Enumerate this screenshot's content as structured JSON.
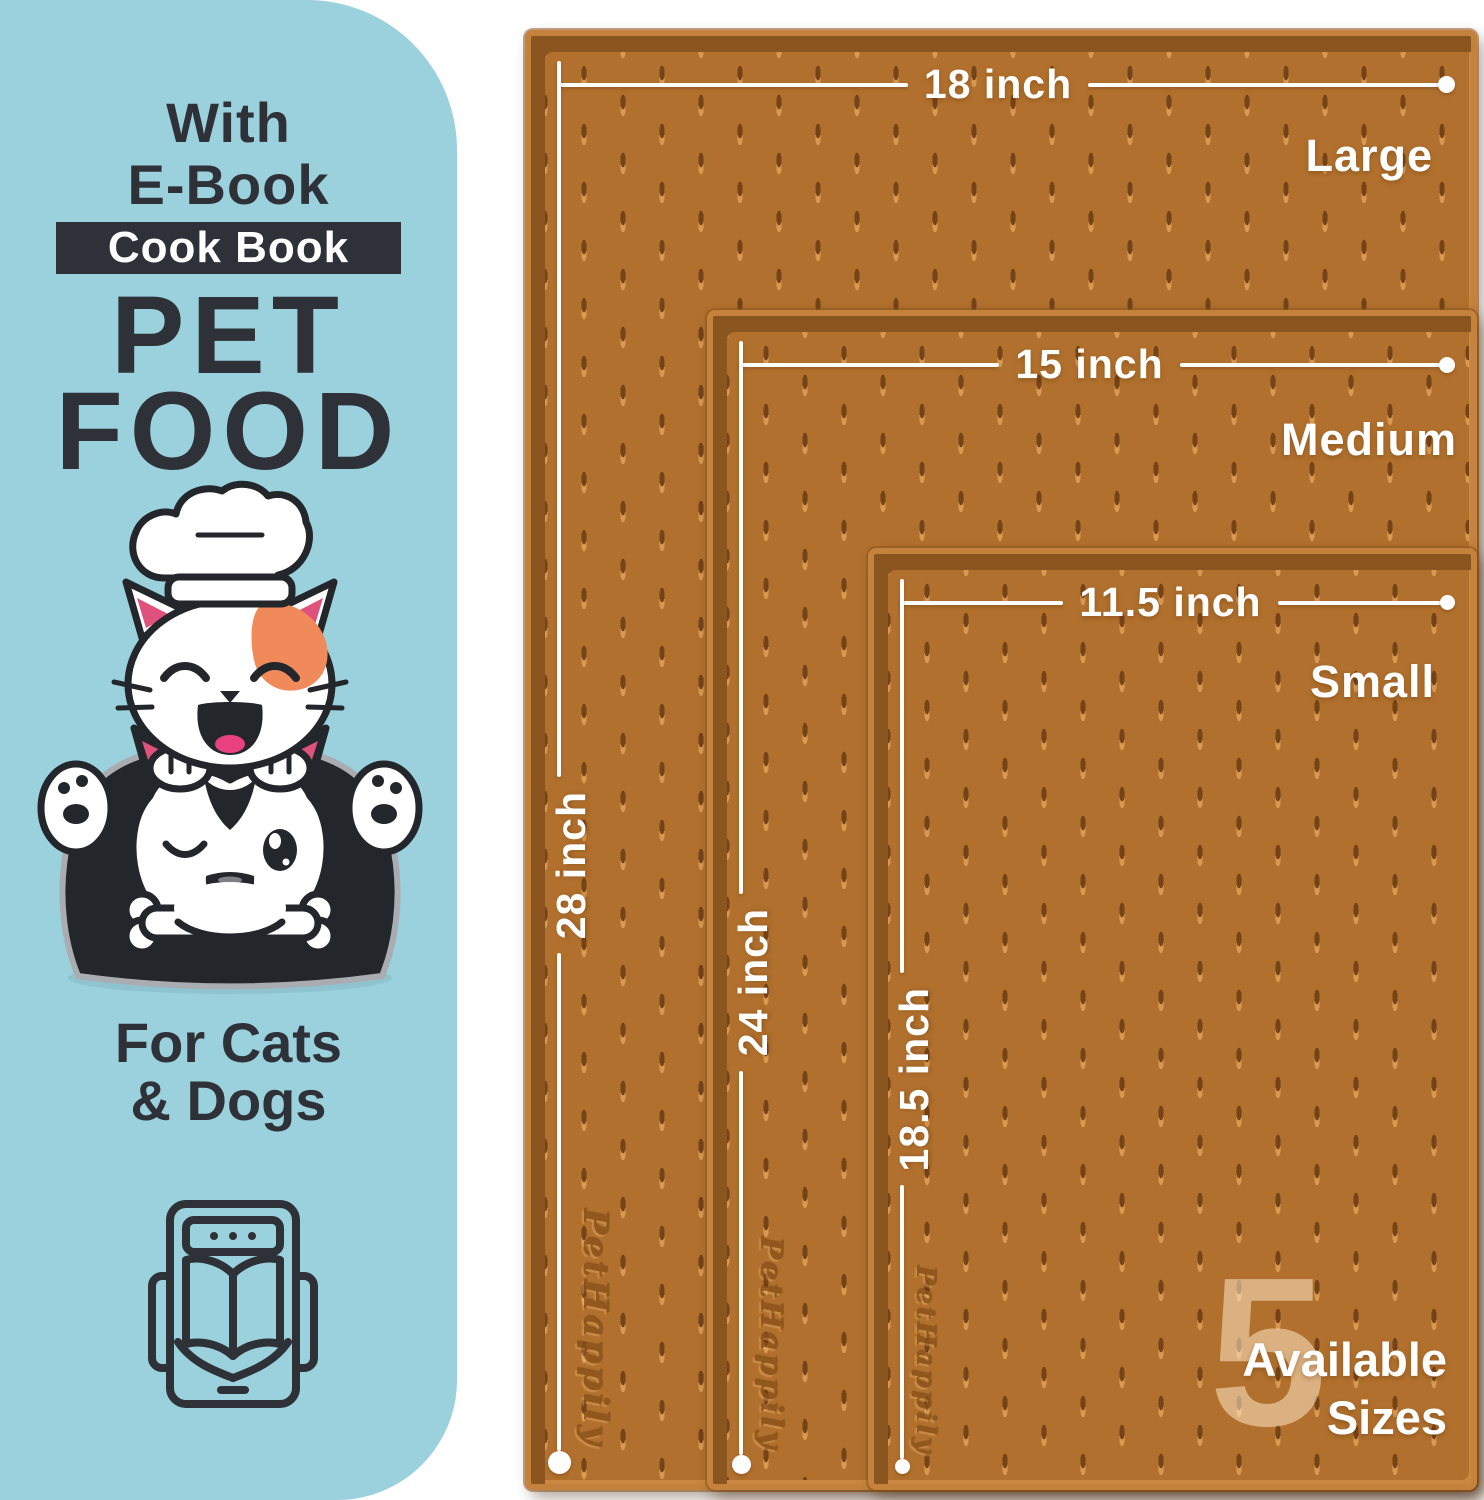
{
  "left_panel": {
    "pre_title_line1": "With",
    "pre_title_line2": "E-Book",
    "badge_label": "Cook Book",
    "title_line1": "PET",
    "title_line2": "FOOD",
    "subtitle_line1": "For Cats",
    "subtitle_line2": "& Dogs"
  },
  "mats": [
    {
      "size_name": "Large",
      "width_label": "18 inch",
      "height_label": "28 inch",
      "brand_embossed": "PetHappily"
    },
    {
      "size_name": "Medium",
      "width_label": "15 inch",
      "height_label": "24 inch",
      "brand_embossed": "PetHappily"
    },
    {
      "size_name": "Small",
      "width_label": "11.5 inch",
      "height_label": "18.5 inch",
      "brand_embossed": "PetHappily"
    }
  ],
  "availability": {
    "count": "5",
    "line1": "Available",
    "line2": "Sizes"
  },
  "colors": {
    "panel_blue": "#9ad1dd",
    "text_dark": "#2e3137",
    "mat_surface": "#b1702d",
    "mat_edge_light": "#c5823c",
    "mat_shadow": "#8a551f",
    "white": "#ffffff",
    "patch_orange": "#f08a5a",
    "ear_pink": "#e0527e",
    "tongue_pink": "#e8417f"
  }
}
